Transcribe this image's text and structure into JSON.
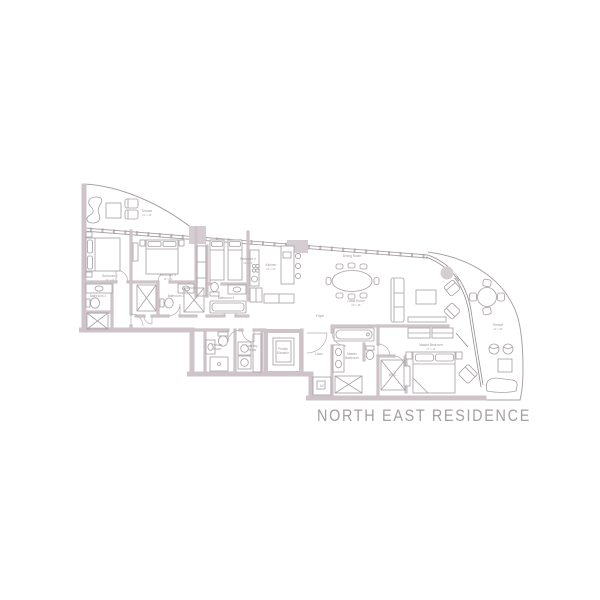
{
  "title": "NORTH EAST RESIDENCE",
  "colors": {
    "background": "#ffffff",
    "wall": "#cdc3c9",
    "wall_fill": "#d6cdd3",
    "outline": "#a8a1a6",
    "furniture": "#aba3a8",
    "label": "#9d979b",
    "title": "#a3a0a1"
  },
  "rooms": {
    "terrace_nw": {
      "label": "Terrace",
      "dims": "21' x 10'"
    },
    "bedroom2": {
      "label": "Bedroom 2",
      "dims": "12' x 11'"
    },
    "bathroom2": {
      "label": "Bathroom 2"
    },
    "bedroom3": {
      "label": "Bedroom 3",
      "dims": "12' x 11'"
    },
    "bathroom3": {
      "label": "Bathroom 3"
    },
    "bedroom4": {
      "label": "Bedroom 4",
      "dims": "12' x 10'"
    },
    "bathroom4": {
      "label": "Bathroom 4"
    },
    "kitchen": {
      "label": "Kitchen",
      "dims": "14' x 10'"
    },
    "dining": {
      "label": "Dining Room"
    },
    "great_room": {
      "label": "Great Room",
      "dims": "20' x 15'"
    },
    "foyer": {
      "label": "Foyer"
    },
    "powder": {
      "line1": "Powder",
      "line2": "Room"
    },
    "laundry": {
      "line1": "Laundry",
      "line2": "Room"
    },
    "elevator": {
      "line1": "Private",
      "line2": "Elevator"
    },
    "linen": {
      "label": "Linen"
    },
    "ac": {
      "label": "AC"
    },
    "master_bath": {
      "line1": "Master",
      "line2": "Bathroom"
    },
    "wic": {
      "label": "W.I.C."
    },
    "master_bed": {
      "label": "Master Bedroom",
      "dims": "17' x 13'"
    },
    "terrace_e": {
      "label": "Terrace",
      "dims": "12' x 26'"
    }
  }
}
